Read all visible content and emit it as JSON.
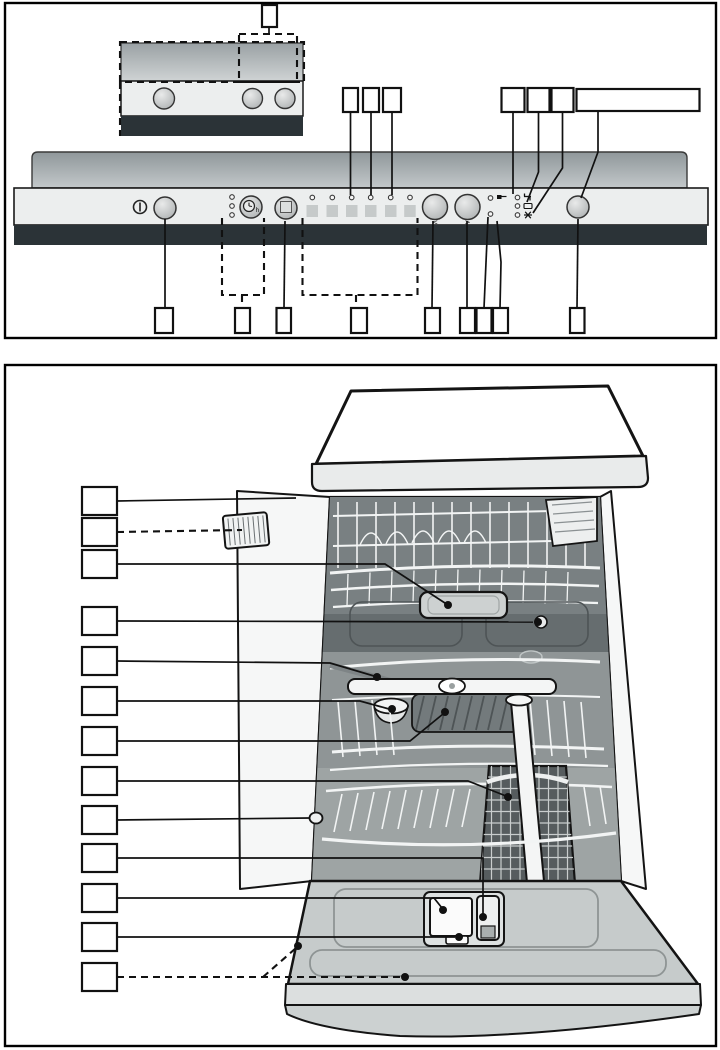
{
  "page": {
    "background": "#ffffff",
    "type": "appliance-manual-diagram-page"
  },
  "figure_control_panel": {
    "title": "control-panel-overview",
    "labels": {
      "prev": "<",
      "next": ">",
      "timer_suffix": "h"
    },
    "icons": {
      "power": "circle-with-bar",
      "delay_timer": "clock",
      "option_button": "square",
      "prev_arrow": "<",
      "next_arrow": ">",
      "active_indicator": "flag",
      "check_water": "tap",
      "rinse_aid": "dish",
      "salt": "asterisk"
    },
    "counts": {
      "program_buttons": 6,
      "program_leds": 6,
      "left_status_leds": 3,
      "right_status_leds": 3,
      "pair_leds": 2
    },
    "colors": {
      "panel": "#eceeee",
      "dark_band": "#2b3337",
      "counter_top": "#8f979a",
      "counter_bottom": "#c3c8ca",
      "program_key": "#c6caca",
      "line": "#111111"
    },
    "annotations": [
      {
        "name": "inset-callout",
        "box": [
          262,
          5,
          15,
          22
        ],
        "lines": [
          {
            "pts": [
              [
                269,
                27
              ],
              [
                269,
                34
              ]
            ],
            "dashed": false
          }
        ]
      },
      {
        "name": "inset-section-outline",
        "rect": [
          239,
          34,
          58,
          48
        ]
      },
      {
        "name": "inset-top-outline",
        "rect": [
          120,
          42,
          184,
          40
        ]
      },
      {
        "name": "inset-left-edge",
        "lines": [
          {
            "pts": [
              [
                120,
                82
              ],
              [
                120,
                136
              ]
            ],
            "dashed": true
          }
        ]
      },
      {
        "name": "program-led-3-callout",
        "box": [
          343,
          88,
          15,
          24
        ],
        "lines": [
          {
            "pts": [
              [
                350.5,
                112
              ],
              [
                350.5,
                195
              ]
            ],
            "dashed": false
          }
        ]
      },
      {
        "name": "program-led-4-callout",
        "box": [
          363,
          88,
          16,
          24
        ],
        "lines": [
          {
            "pts": [
              [
                371,
                112
              ],
              [
                371,
                195
              ]
            ],
            "dashed": false
          }
        ]
      },
      {
        "name": "program-led-5-callout",
        "box": [
          383,
          88,
          18,
          24
        ],
        "lines": [
          {
            "pts": [
              [
                392,
                112
              ],
              [
                392,
                195
              ]
            ],
            "dashed": false
          }
        ]
      },
      {
        "name": "water-indicator-callout",
        "box": [
          501.5,
          88,
          23,
          24
        ],
        "lines": [
          {
            "pts": [
              [
                513,
                112
              ],
              [
                513,
                194
              ]
            ],
            "dashed": false
          }
        ]
      },
      {
        "name": "rinse-aid-indicator-callout",
        "box": [
          527.5,
          88,
          22,
          24
        ],
        "lines": [
          {
            "pts": [
              [
                538.5,
                112
              ],
              [
                538.5,
                172
              ],
              [
                527,
                202
              ]
            ],
            "dashed": false
          }
        ]
      },
      {
        "name": "salt-indicator-callout",
        "box": [
          551.5,
          88,
          22,
          24
        ],
        "lines": [
          {
            "pts": [
              [
                562.5,
                112
              ],
              [
                562.5,
                168
              ],
              [
                533,
                213
              ]
            ],
            "dashed": false
          }
        ]
      },
      {
        "name": "start-button-callout",
        "box": [
          576.5,
          89,
          123,
          22
        ],
        "lines": [
          {
            "pts": [
              [
                598,
                111
              ],
              [
                598,
                152
              ],
              [
                581,
                198
              ]
            ],
            "dashed": false
          }
        ]
      },
      {
        "name": "on-off-button-callout",
        "box": [
          155,
          308,
          18,
          25
        ],
        "lines": [
          {
            "pts": [
              [
                165,
                219
              ],
              [
                165,
                308
              ]
            ],
            "dashed": false
          }
        ]
      },
      {
        "name": "timer-group-outline",
        "lines": [
          {
            "pts": [
              [
                222,
                218
              ],
              [
                222,
                295
              ],
              [
                264,
                295
              ],
              [
                264,
                218
              ]
            ],
            "dashed": true
          },
          {
            "pts": [
              [
                242,
                295
              ],
              [
                242,
                308
              ]
            ],
            "dashed": true
          }
        ]
      },
      {
        "name": "timer-group-callout",
        "box": [
          235,
          308,
          15,
          25
        ]
      },
      {
        "name": "option-button-callout",
        "box": [
          276.5,
          308,
          14.5,
          25
        ],
        "lines": [
          {
            "pts": [
              [
                285,
                221
              ],
              [
                284,
                308
              ]
            ],
            "dashed": false
          }
        ]
      },
      {
        "name": "program-group-outline",
        "lines": [
          {
            "pts": [
              [
                302.5,
                218
              ],
              [
                302.5,
                295
              ],
              [
                417.5,
                295
              ],
              [
                417.5,
                218
              ]
            ],
            "dashed": true
          },
          {
            "pts": [
              [
                356,
                295
              ],
              [
                356,
                308
              ]
            ],
            "dashed": true
          }
        ]
      },
      {
        "name": "program-group-callout",
        "box": [
          351,
          308,
          16,
          25
        ]
      },
      {
        "name": "prev-button-callout",
        "box": [
          425,
          308,
          15,
          25
        ],
        "lines": [
          {
            "pts": [
              [
                433,
                221
              ],
              [
                432,
                308
              ]
            ],
            "dashed": false
          }
        ]
      },
      {
        "name": "next-button-callout",
        "box": [
          460,
          308,
          15,
          25
        ],
        "lines": [
          {
            "pts": [
              [
                467,
                221
              ],
              [
                467,
                308
              ]
            ],
            "dashed": false
          }
        ]
      },
      {
        "name": "led-a-callout",
        "box": [
          476.5,
          308,
          15,
          25
        ],
        "lines": [
          {
            "pts": [
              [
                488,
                217
              ],
              [
                484,
                308
              ]
            ],
            "dashed": false
          }
        ]
      },
      {
        "name": "led-b-callout",
        "box": [
          493,
          308,
          15,
          25
        ],
        "lines": [
          {
            "pts": [
              [
                497,
                221
              ],
              [
                501,
                262
              ],
              [
                500,
                308
              ]
            ],
            "dashed": false
          }
        ]
      },
      {
        "name": "start-button-bottom-callout",
        "box": [
          570,
          308,
          14.5,
          25
        ],
        "lines": [
          {
            "pts": [
              [
                578,
                219
              ],
              [
                577,
                308
              ]
            ],
            "dashed": false
          }
        ]
      }
    ]
  },
  "figure_interior": {
    "title": "dishwasher-interior-overview",
    "callout_count": 13,
    "annotations": [
      {
        "name": "upper-basket-callout",
        "box": [
          82,
          487,
          35,
          28
        ],
        "lines": [
          {
            "pts": [
              [
                117,
                501
              ],
              [
                296,
                498
              ]
            ],
            "dashed": false
          }
        ]
      },
      {
        "name": "left-tray-callout",
        "box": [
          82,
          518,
          35,
          28
        ],
        "lines": [
          {
            "pts": [
              [
                117,
                532
              ],
              [
                242,
                530
              ]
            ],
            "dashed": true
          }
        ]
      },
      {
        "name": "center-tray-callout",
        "box": [
          82,
          550,
          35,
          28
        ],
        "lines": [
          {
            "pts": [
              [
                117,
                564
              ],
              [
                385,
                564
              ],
              [
                448,
                605
              ]
            ],
            "dashed": false
          }
        ],
        "dots": [
          [
            448,
            605
          ]
        ]
      },
      {
        "name": "basket-roller-callout",
        "box": [
          82,
          607,
          35,
          28
        ],
        "lines": [
          {
            "pts": [
              [
                117,
                621
              ],
              [
                533,
                622
              ]
            ],
            "dashed": false
          }
        ],
        "dots": [
          [
            538,
            622
          ]
        ]
      },
      {
        "name": "front-rail-callout",
        "box": [
          82,
          647,
          35,
          28
        ],
        "lines": [
          {
            "pts": [
              [
                117,
                661
              ],
              [
                330,
                663
              ],
              [
                374,
                676
              ]
            ],
            "dashed": false
          }
        ],
        "dots": [
          [
            377,
            677
          ]
        ]
      },
      {
        "name": "bowl-callout",
        "box": [
          82,
          687,
          35,
          28
        ],
        "lines": [
          {
            "pts": [
              [
                117,
                701
              ],
              [
                360,
                701
              ],
              [
                389,
                709
              ]
            ],
            "dashed": false
          }
        ],
        "dots": [
          [
            392,
            709
          ]
        ]
      },
      {
        "name": "spray-area-callout",
        "box": [
          82,
          727,
          35,
          28
        ],
        "lines": [
          {
            "pts": [
              [
                117,
                741
              ],
              [
                410,
                741
              ],
              [
                443,
                714
              ]
            ],
            "dashed": false
          }
        ],
        "dots": [
          [
            445,
            712
          ]
        ]
      },
      {
        "name": "cutlery-basket-callout",
        "box": [
          82,
          767,
          35,
          28
        ],
        "lines": [
          {
            "pts": [
              [
                117,
                781
              ],
              [
                468,
                781
              ],
              [
                506,
                796
              ]
            ],
            "dashed": false
          }
        ],
        "dots": [
          [
            508,
            797
          ]
        ]
      },
      {
        "name": "lower-basket-callout",
        "box": [
          82,
          806,
          35,
          28
        ],
        "lines": [
          {
            "pts": [
              [
                117,
                820
              ],
              [
                310,
                818
              ]
            ],
            "dashed": false
          }
        ]
      },
      {
        "name": "dispenser-unit-callout",
        "box": [
          82,
          844,
          35,
          28
        ],
        "lines": [
          {
            "pts": [
              [
                117,
                858
              ],
              [
                483,
                858
              ],
              [
                483,
                914
              ]
            ],
            "dashed": false
          }
        ],
        "dots": [
          [
            483,
            917
          ]
        ]
      },
      {
        "name": "detergent-dispenser-callout",
        "box": [
          82,
          884,
          35,
          28
        ],
        "lines": [
          {
            "pts": [
              [
                117,
                898
              ],
              [
                434,
                898
              ],
              [
                442,
                908
              ]
            ],
            "dashed": false
          }
        ],
        "dots": [
          [
            443,
            910
          ]
        ]
      },
      {
        "name": "dispenser-latch-callout",
        "box": [
          82,
          923,
          35,
          28
        ],
        "lines": [
          {
            "pts": [
              [
                117,
                937
              ],
              [
                455,
                937
              ]
            ],
            "dashed": false
          }
        ],
        "dots": [
          [
            459,
            937
          ]
        ]
      },
      {
        "name": "inner-door-callout",
        "box": [
          82,
          963,
          35,
          28
        ],
        "lines": [
          {
            "pts": [
              [
                117,
                977
              ],
              [
                403,
                977
              ]
            ],
            "dashed": true
          },
          {
            "pts": [
              [
                263,
                977
              ],
              [
                296,
                948
              ]
            ],
            "dashed": true
          }
        ],
        "dots": [
          [
            405,
            977
          ],
          [
            298,
            946
          ]
        ]
      }
    ]
  }
}
